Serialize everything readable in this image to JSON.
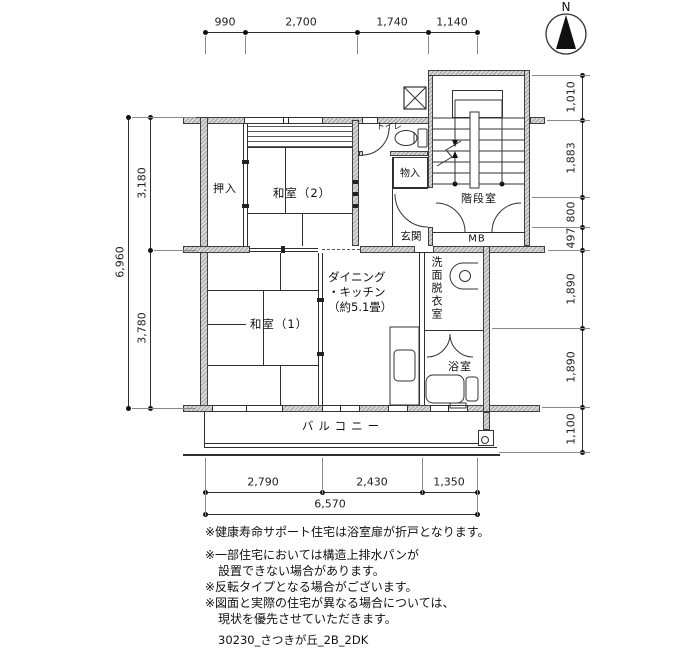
{
  "compass": {
    "label": "N"
  },
  "dimensions": {
    "top": [
      "990",
      "2,700",
      "1,740",
      "1,140"
    ],
    "left": {
      "total": "6,960",
      "upper": "3,180",
      "lower": "3,780"
    },
    "right": [
      "1,010",
      "1,883",
      "800",
      "497",
      "1,890",
      "1,890",
      "1,100"
    ],
    "bottom": {
      "segments": [
        "2,790",
        "2,430",
        "1,350"
      ],
      "total": "6,570"
    }
  },
  "rooms": {
    "oshiire": "押入",
    "washitsu2": "和室（2）",
    "toilet": "トイレ",
    "monoire": "物入",
    "genkan": "玄関",
    "kaidanshitsu": "階段室",
    "mb": "MB",
    "washitsu1": "和室（1）",
    "dk_line1": "ダイニング",
    "dk_line2": "・キッチン",
    "dk_line3": "（約5.1畳）",
    "senmen_datsuishitsu": "洗面脱衣室",
    "yokushitsu": "浴室",
    "balcony": "バルコニー"
  },
  "notes": [
    "※健康寿命サポート住宅は浴室扉が折戸となります。",
    "※一部住宅においては構造上排水パンが",
    "設置できない場合があります。",
    "※反転タイプとなる場合がございます。",
    "※図面と実際の住宅が異なる場合については、",
    "現状を優先させていただきます。"
  ],
  "footer": {
    "plan_code": "30230_さつきが丘_2B_2DK"
  }
}
